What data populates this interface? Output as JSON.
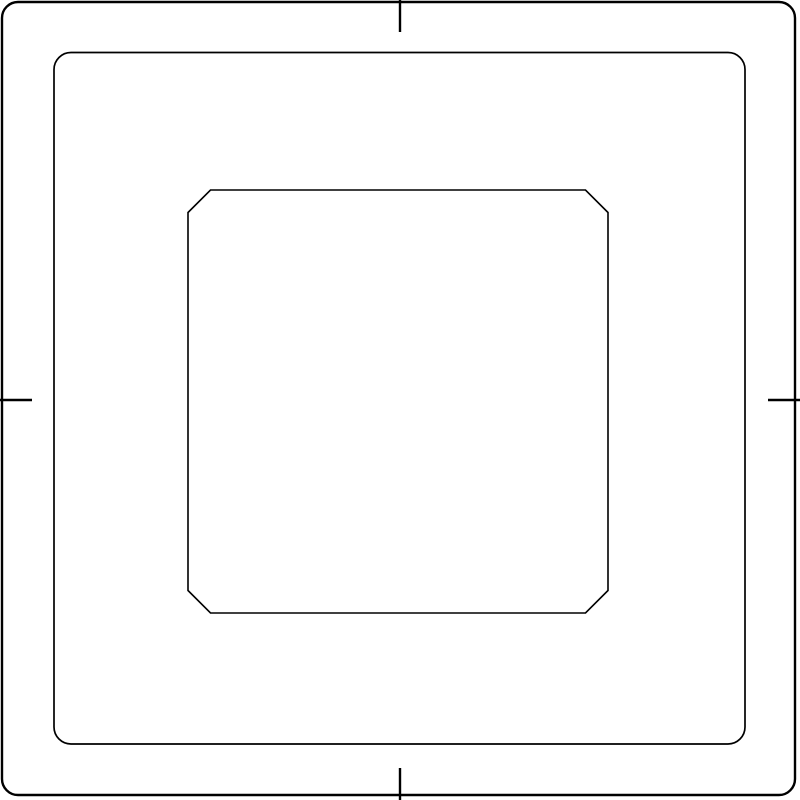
{
  "diagram": {
    "title": "plate-outline-drawing",
    "viewbox": "0 0 800 800",
    "canvas": {
      "width": 800,
      "height": 800
    },
    "colors": {
      "background": "#ffffff",
      "line": "#000000"
    },
    "outer_frame": {
      "x": 2,
      "y": 2,
      "width": 793,
      "height": 793,
      "corner_radius": 16,
      "stroke_width": 2.4
    },
    "middle_frame": {
      "x": 54,
      "y": 52.5,
      "width": 691,
      "height": 691.5,
      "corner_radius": 17,
      "stroke_width": 1.7
    },
    "inner_window": {
      "x": 188,
      "y": 190,
      "width": 420,
      "height": 423,
      "chamfer": 22.5,
      "stroke_width": 1.6
    },
    "center_marks": {
      "length": 32,
      "stroke_width": 2.4,
      "sides": [
        "top",
        "right",
        "bottom",
        "left"
      ]
    }
  }
}
